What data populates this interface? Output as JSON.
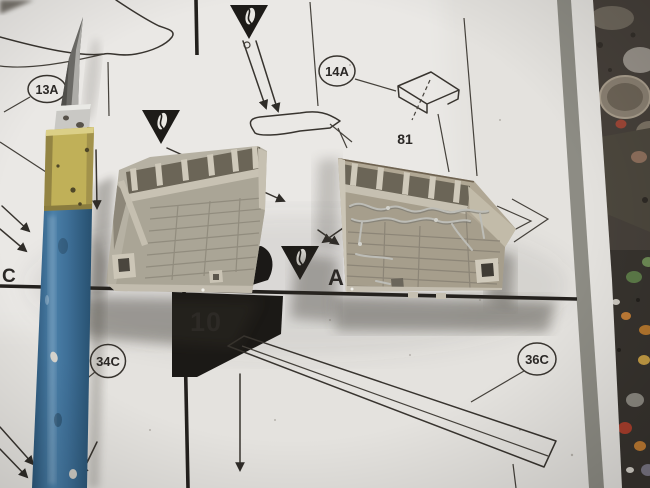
{
  "sheet": {
    "step_number": "10",
    "callout_13a": "13A",
    "callout_14a": "14A",
    "part_number_81": "81",
    "callout_34c": "34C",
    "callout_36c": "36C",
    "edge_callout_c": "C",
    "glue_letter_a": "A"
  },
  "colors": {
    "paper": "#e4e2de",
    "print_ink": "#38342f",
    "stripe_gray": "#8d8c84",
    "bench_dark": "#46403a",
    "bench_lower": "#37332e",
    "flag_black": "#1b1916",
    "plastic_left": "#b6b1a3",
    "plastic_right": "#b0a794",
    "plastic_rib_light": "#cfc9ba",
    "plastic_recess": "#6b6557",
    "wire_silver": "#bdbdb7",
    "blade_steel": "#6b6a66",
    "ferrule_silver": "#c9c8c4",
    "grip_yellow": "#c0b058",
    "handle_blue": "#3c6c92"
  }
}
